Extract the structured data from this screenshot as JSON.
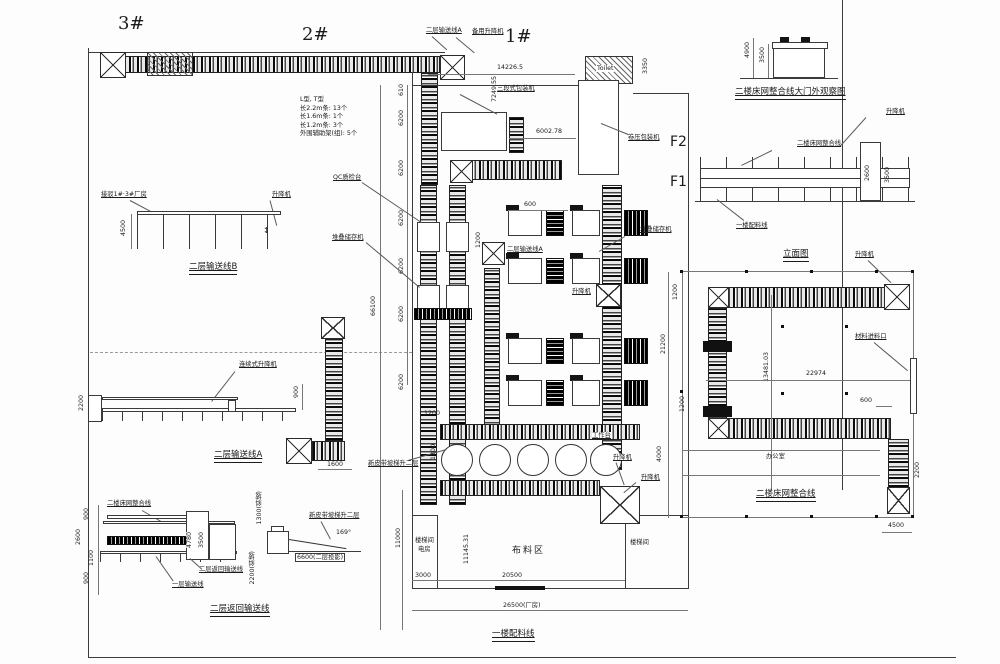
{
  "buildings": {
    "b3": "3#",
    "b2": "2#",
    "b1": "1#",
    "f2": "F2",
    "f1": "F1"
  },
  "rooms": {
    "toilet": "Toilet",
    "office": "办公室",
    "fabric": "布料区",
    "stair1a": "楼梯间",
    "stair1b": "电房",
    "stair2": "楼梯间"
  },
  "captions": {
    "gate": "二楼床网整合线大门外观察图",
    "elev": "立面图",
    "bednet": "二楼床网整合线",
    "lineb": "二层输送线B",
    "linea": "二层输送线A",
    "ret": "二层返回输送线",
    "feed": "一楼配料线"
  },
  "labels": {
    "conv_a_top": "二层输送线A",
    "backup_lift": "备用升降机",
    "packer3": "三段式包装机",
    "roll_packer": "卷压包装机",
    "lift1": "升降机",
    "lift2": "升降机",
    "lift3": "升降机",
    "lift4": "升降机",
    "lift5": "升降机",
    "lift6": "升降机",
    "qc": "QC质检台",
    "stacker_l": "堆叠储存机",
    "stacker_r": "堆叠储存机",
    "conv_a_mid": "二层输送线A",
    "workbench": "工作台",
    "inlet": "材料进料口",
    "bednet_elev": "二楼床网整合线",
    "feed_elev": "一楼配料线",
    "connect": "接驳1#·3#厂房",
    "cont_lift": "连续式升降机",
    "bednet_bl": "二楼床网整合线",
    "ret_bl": "二层返回输送线",
    "floor1_conv": "一层输送线",
    "ramp_plan": "新皮带坡梯升二层",
    "ramp_sketch": "新皮带坡梯升二层"
  },
  "note": {
    "l1": "L型, T型",
    "l2": "长2.2m条: 13个",
    "l3": "长1.6m条: 1个",
    "l4": "长1.2m条: 3个",
    "l5": "外围辅助架(组): 5个"
  },
  "dims": {
    "d14226": "14226.5",
    "d7249": "7249.55",
    "d3350": "3350",
    "d6002": "6002.78",
    "d4900": "4900",
    "d3500g": "3500",
    "d2600e": "2600",
    "d3500e": "3500",
    "d21200": "21200",
    "d13481": "13481.03",
    "d22974": "22974",
    "d600u": "600",
    "d1200u": "1200",
    "d4000": "4000",
    "d2200u": "2200",
    "d4500u": "4500",
    "d4500b": "4500",
    "d2200a": "2200",
    "d900a": "900",
    "d1600": "1600",
    "d900b1": "900",
    "d2600b": "2600",
    "d1100": "1100",
    "d900b2": "900",
    "d4780": "4780",
    "d3500b": "3500",
    "d1300r": "1300(斜坡)",
    "d2200r": "2200(斜坡)",
    "d6600": "6600(二层投影)",
    "a169": "169°",
    "d610": "610",
    "d6200": "6200",
    "d66100": "66100",
    "d11000": "11000",
    "d3000": "3000",
    "d20500": "20500",
    "d26500": "26500(厂房)",
    "d11145": "11145.31",
    "d600c": "600",
    "d1200a": "1200",
    "d1200b": "1200",
    "d1200c": "1200",
    "d1200d": "1200"
  }
}
